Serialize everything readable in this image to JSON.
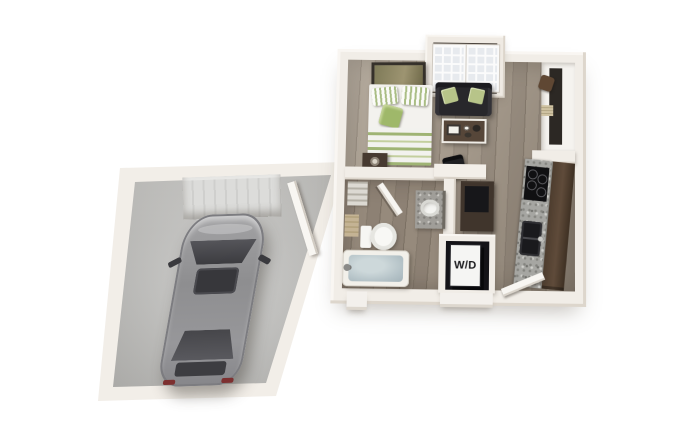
{
  "scene": {
    "type": "3d-floor-plan-render",
    "title": "Studio apartment floor plan with attached single-car garage",
    "view": "elevated isometric top-down"
  },
  "labels": {
    "washer_dryer": "W/D"
  },
  "rooms": [
    {
      "name": "Bedroom / Living Area",
      "floor": "wood plank",
      "furniture": [
        "bed with green striped bedding and pillows",
        "green throw pillow",
        "framed wall art",
        "nightstand with lamp",
        "black sofa with two green accent pillows",
        "coffee table with white tray and dishes",
        "desk with black top",
        "black desk chair"
      ]
    },
    {
      "name": "French Door Alcove",
      "floor": "dark threshold",
      "furniture": [
        "double french doors with divided glass panes"
      ]
    },
    {
      "name": "Entry Closet",
      "floor": "white",
      "furniture": [
        "shelving strip",
        "brown storage item",
        "woven basket"
      ]
    },
    {
      "name": "Kitchen",
      "floor": "wood plank",
      "furniture": [
        "dark wood cabinet run",
        "speckled granite countertop",
        "black cooktop with four burners",
        "black double-basin sink with faucet"
      ]
    },
    {
      "name": "Bathroom",
      "floor": "wood plank",
      "furniture": [
        "linen shelves with towels",
        "tan storage cabinet",
        "toilet",
        "bathtub filled with water",
        "granite vanity with round white sink",
        "open door"
      ]
    },
    {
      "name": "Laundry Closet",
      "floor": "dark alcove",
      "furniture": [
        "stacked washer/dryer unit labeled W/D"
      ]
    },
    {
      "name": "Garage",
      "floor": "concrete",
      "furniture": [
        "silver sedan seen from above",
        "ribbed garage door",
        "open door connecting to unit"
      ]
    }
  ],
  "colors": {
    "background": "#ffffff",
    "wall": "#f1ede7",
    "wall_shadow": "#dcd5cb",
    "wood_floor": "#978b7e",
    "bathroom_floor": "#877b6e",
    "concrete_floor": "#c6c6c4",
    "garage_door": "#d6d6d4",
    "accent_green": "#aebf7f",
    "sofa_black": "#28272b",
    "cabinet_brown": "#4f3e30",
    "granite": "#a6a6a2",
    "car_silver": "#939396",
    "tub_water": "#b4c2c7",
    "wd_text": "#17171a"
  }
}
